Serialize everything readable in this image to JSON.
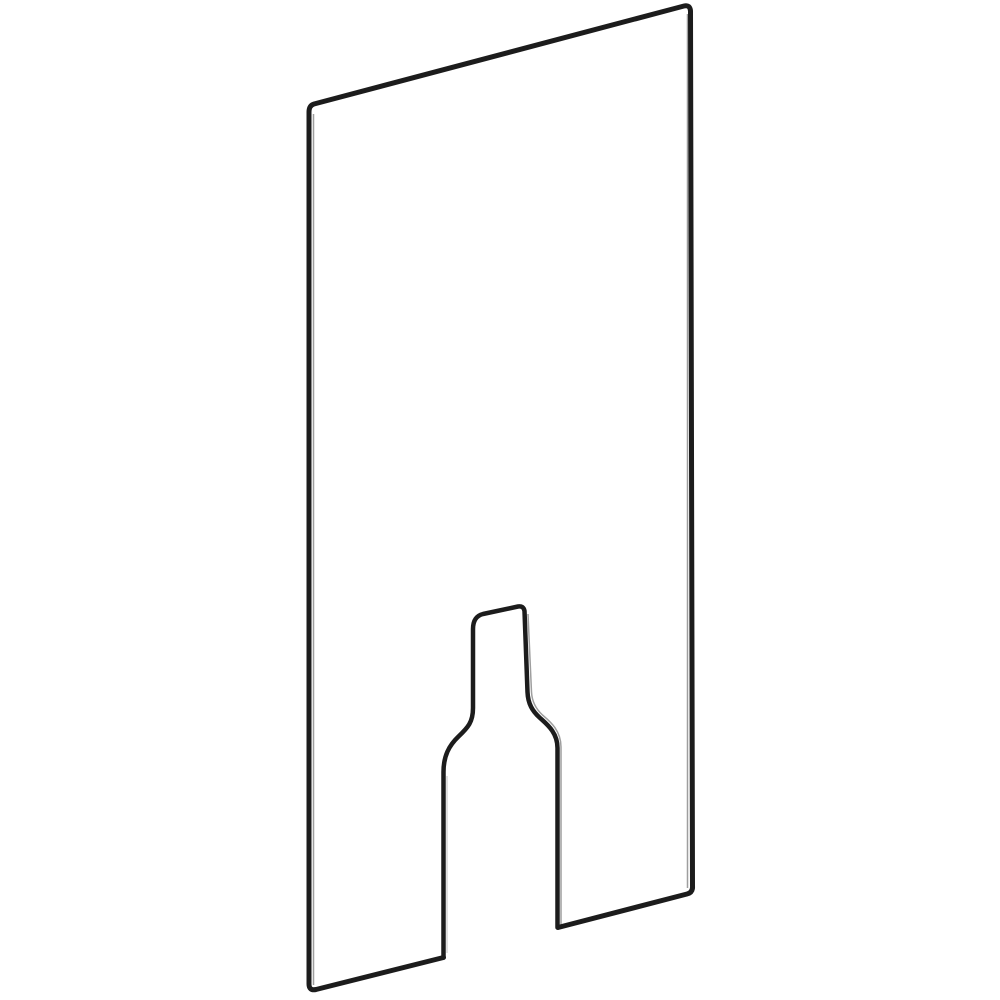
{
  "page": {
    "background": "#ffffff",
    "width": 1000,
    "height": 1000
  },
  "figure": {
    "subject": "technical-line-illustration-of-flat-panel-with-keyhole-cutout",
    "style": "isometric-outline-drawing",
    "colors": {
      "background": "#ffffff",
      "stroke": "#1c1c1c",
      "thin_edge": "#9e9e9e",
      "faint_edge": "#cccccc"
    },
    "stroke_widths": {
      "outline": 5,
      "cutout": 4.5,
      "thin": 1.5,
      "faint": 1.2
    },
    "paths": {
      "panel_outline": "M 443.5,957.5 L 316,989.5 Q 309,991 309,984 L 309,112 Q 309,105.5 314,104 L 684,6 Q 690,4.5 690.5,11 L 692.5,886 Q 693,892.5 687,894 L 558,927.5",
      "keyhole_cutout": "M 443.5,957.5 L 443.5,772 C 443.5,756 449,745.5 458.5,736.5 C 468,727.5 473,722 473,708 L 473,629 Q 473,616.5 483,614 L 518,606.5 Q 523.5,605.5 524.5,611 L 527.5,692 C 528,704 532.5,711 539.5,717.5 C 546.5,724 557.5,732 557.5,748 L 557.5,927.5",
      "edge_highlights": [
        "M 313.5,114 L 313.5,985",
        "M 687.5,14 L 687.5,888",
        "M 528,614 L 531.5,692 C 532,702 536,709 542.5,715 C 549.5,721 561,730 561,747 L 561,925"
      ],
      "faint_highlights": [
        "M 447,776 L 447,953"
      ]
    },
    "viewbox": "0 0 1000 1000"
  }
}
